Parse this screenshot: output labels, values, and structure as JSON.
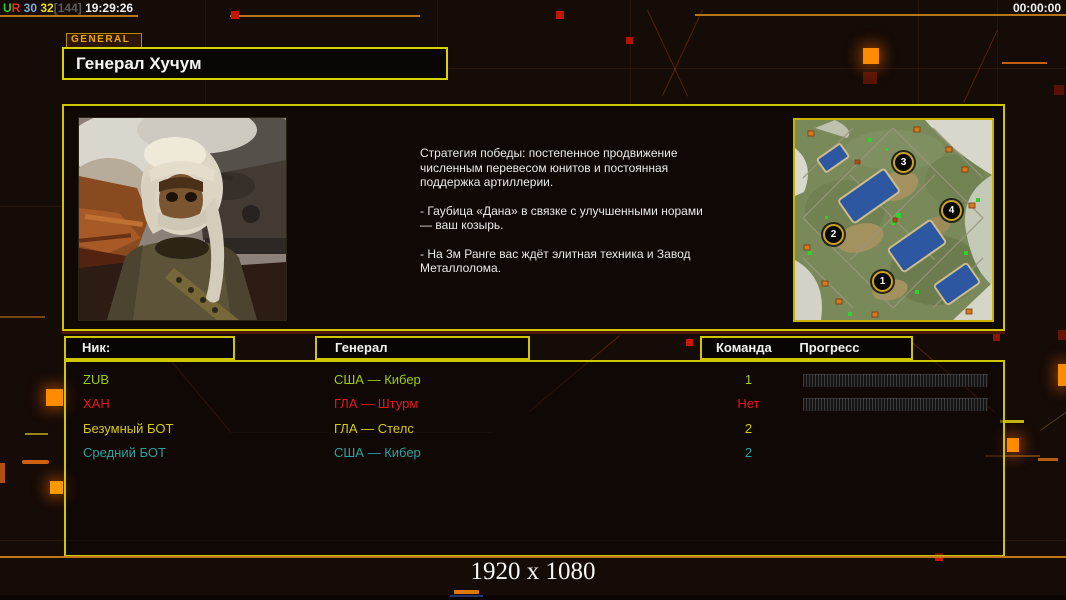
{
  "status_bar": {
    "left": [
      {
        "text": "U",
        "color": "#2ecc2e"
      },
      {
        "text": "R",
        "color": "#e03020"
      },
      {
        "text": " 30",
        "color": "#7fa8d8"
      },
      {
        "text": " 32",
        "color": "#e8e020"
      },
      {
        "text": "[144]",
        "color": "#5a5a5a"
      },
      {
        "text": " 19:29:26",
        "color": "#f0f0f0"
      }
    ],
    "timer": "00:00:00"
  },
  "tab_label": "GENERAL",
  "general_name": "Генерал Хучум",
  "briefing_paragraphs": [
    "Стратегия победы: постепенное продвижение численным перевесом юнитов и постоянная поддержка артиллерии.",
    "- Гаубица «Дана» в связке с улучшенными норами — ваш козырь.",
    "- На 3м Ранге вас ждёт элитная техника и Завод Металлолома."
  ],
  "minimap": {
    "markers": [
      {
        "label": "1"
      },
      {
        "label": "2"
      },
      {
        "label": "3"
      },
      {
        "label": "4"
      }
    ]
  },
  "players": {
    "headers": {
      "nick": "Ник:",
      "general": "Генерал",
      "team": "Команда",
      "progress": "Прогресс"
    },
    "rows": [
      {
        "nick": "ZUB",
        "general": "США — Кибер",
        "team": "1",
        "color": "#9ccd12"
      },
      {
        "nick": "ХАН",
        "general": "ГЛА — Штурм",
        "team": "Нет",
        "color": "#e51818"
      },
      {
        "nick": "Безумный БОТ",
        "general": "ГЛА — Стелс",
        "team": "2",
        "color": "#d6ca10"
      },
      {
        "nick": "Средний БОТ",
        "general": "США — Кибер",
        "team": "2",
        "color": "#2fa0a0"
      }
    ]
  },
  "footer": {
    "resolution_label": "1920 x 1080"
  }
}
